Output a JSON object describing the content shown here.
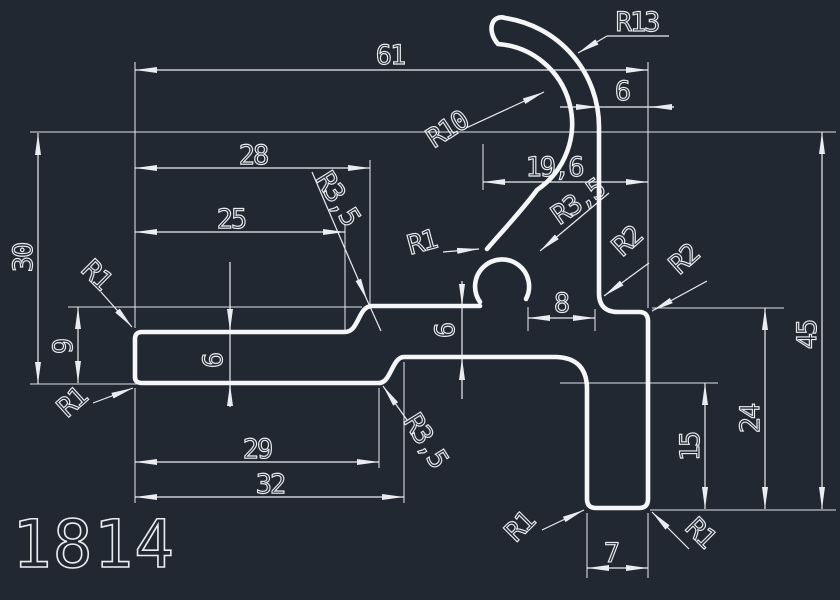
{
  "app": {
    "background_color": "#222831",
    "line_color": "#e9edf2"
  },
  "drawing_number": "1814",
  "dimensions": {
    "overall_width": "61",
    "top_offset": "6",
    "hook_width": "19,6",
    "step_top": "28",
    "step_top_inner": "25",
    "overall_left_height": "30",
    "left_height": "9",
    "tongue_thickness": "6",
    "band_thickness": "6",
    "slot_width": "8",
    "bottom_step_inner": "29",
    "bottom_step": "32",
    "leg_width": "7",
    "leg_height": "15",
    "right_height": "24",
    "overall_height": "45"
  },
  "radii": {
    "hook_outer": "R13",
    "hook_inner": "R10",
    "knob_junction": "R1",
    "knob": "R3,5",
    "step_top": "R3,5",
    "step_bottom": "R3,5",
    "leg_fillet": "R2",
    "corner_fillet": "R2",
    "tongue_top": "R1",
    "tongue_bottom": "R1",
    "leg_bottom_left": "R1",
    "leg_bottom_right": "R1"
  }
}
